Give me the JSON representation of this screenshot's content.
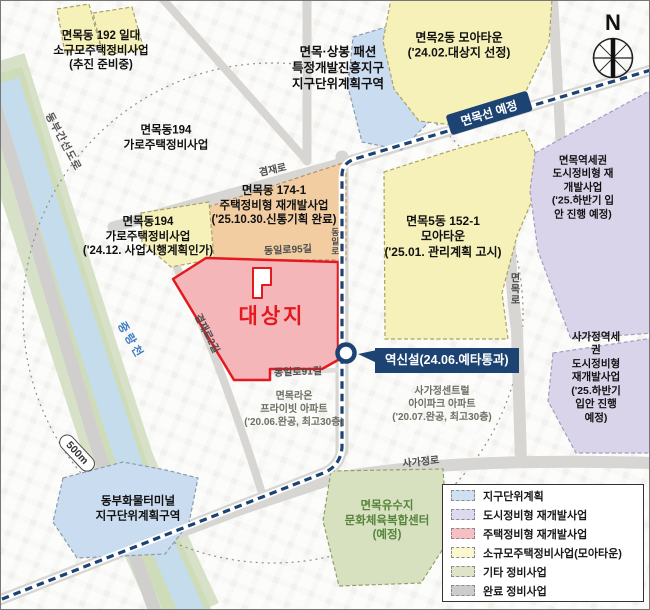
{
  "compass": {
    "north_label": "N"
  },
  "scale": {
    "ring_label": "500m"
  },
  "transit": {
    "line_label": "면목선 예정",
    "station_label": "역신설(24.06.예타통과)"
  },
  "target": {
    "label": "대상지"
  },
  "zone_labels": {
    "z192": "면목동 192 일대\n소규모주택정비사업\n(추진 준비중)",
    "fashion": "면목·상봉 패션\n특정개발진흥지구\n지구단위계획구역",
    "moatown2": "면목2동 모아타운\n('24.02.대상지 선정)",
    "m194": "면목동194\n가로주택정비사업",
    "m194b": "면목동194\n가로주택정비사업\n('24.12. 사업시행계획인가)",
    "m174": "면목동 174-1\n주택정비형 재개발사업\n('25.10.30.신통기획 완료)",
    "m152": "면목5동 152-1\n모아타운\n('25.01. 관리계획 고시)",
    "mstation": "면목역세권\n도시정비형 재개발사업\n('25.하반기 입안 진행 예정)",
    "sagajeong": "사가정역세권\n도시정비형 재개발사업\n('25.하반기 입안 진행 예정)",
    "terminal": "동부화물터미널\n지구단위계획구역",
    "yusuji": "면목유수지\n문화체육복합센터\n(예정)"
  },
  "apartments": {
    "raon": "면목라온\n프라이빗 아파트\n('20.06.완공, 최고30층)",
    "ipark": "사가정센트럴\n아이파크 아파트\n('20.07.완공, 최고30층)"
  },
  "roads": {
    "gyeomjae": "겸재로",
    "gyeomjae2": "겸재로2길",
    "dongil95": "동일로95길",
    "dongil91": "동일로91길",
    "dongil": "동일로",
    "myeonmokro": "면목로",
    "sagajeongro": "사가정로",
    "dongbu": "동부간선도로"
  },
  "river": {
    "name": "중랑천"
  },
  "legend": {
    "items": [
      {
        "label": "지구단위계획",
        "color": "#cfe0f2"
      },
      {
        "label": "도시정비형 재개발사업",
        "color": "#ded9ee"
      },
      {
        "label": "주택정비형 재개발사업",
        "color": "#f6bfc4"
      },
      {
        "label": "소규모주택정비사업(모아타운)",
        "color": "#fbf7cf"
      },
      {
        "label": "기타 정비사업",
        "color": "#dee4c8"
      },
      {
        "label": "완료 정비사업",
        "color": "#cccccc"
      }
    ]
  },
  "colors": {
    "rail_line": "#1c4372",
    "target_border": "#e3191f",
    "target_fill": "#f5b6b9",
    "river": "#c5dcec"
  }
}
